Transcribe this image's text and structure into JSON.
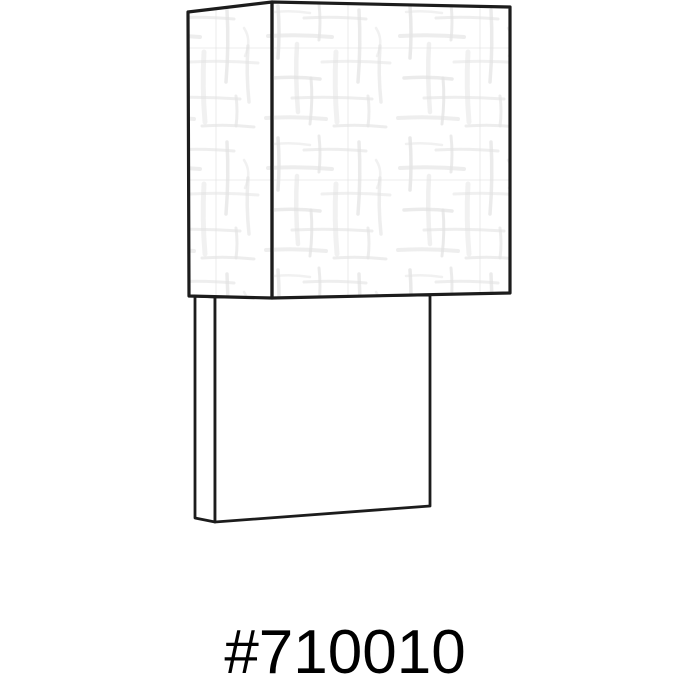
{
  "page": {
    "background_color": "#ffffff"
  },
  "illustration": {
    "description": "Black-and-white line drawing of a rectangular wall sconce: a square linen-textured shade over a narrow rectangular backplate, shown in slight three-quarter perspective",
    "outline_color": "#1c1c1c",
    "texture_color": "#e3e3e3",
    "shade_fill": "#ffffff",
    "backplate_fill": "#ffffff"
  },
  "caption": {
    "text": "#710010",
    "color": "#000000"
  }
}
